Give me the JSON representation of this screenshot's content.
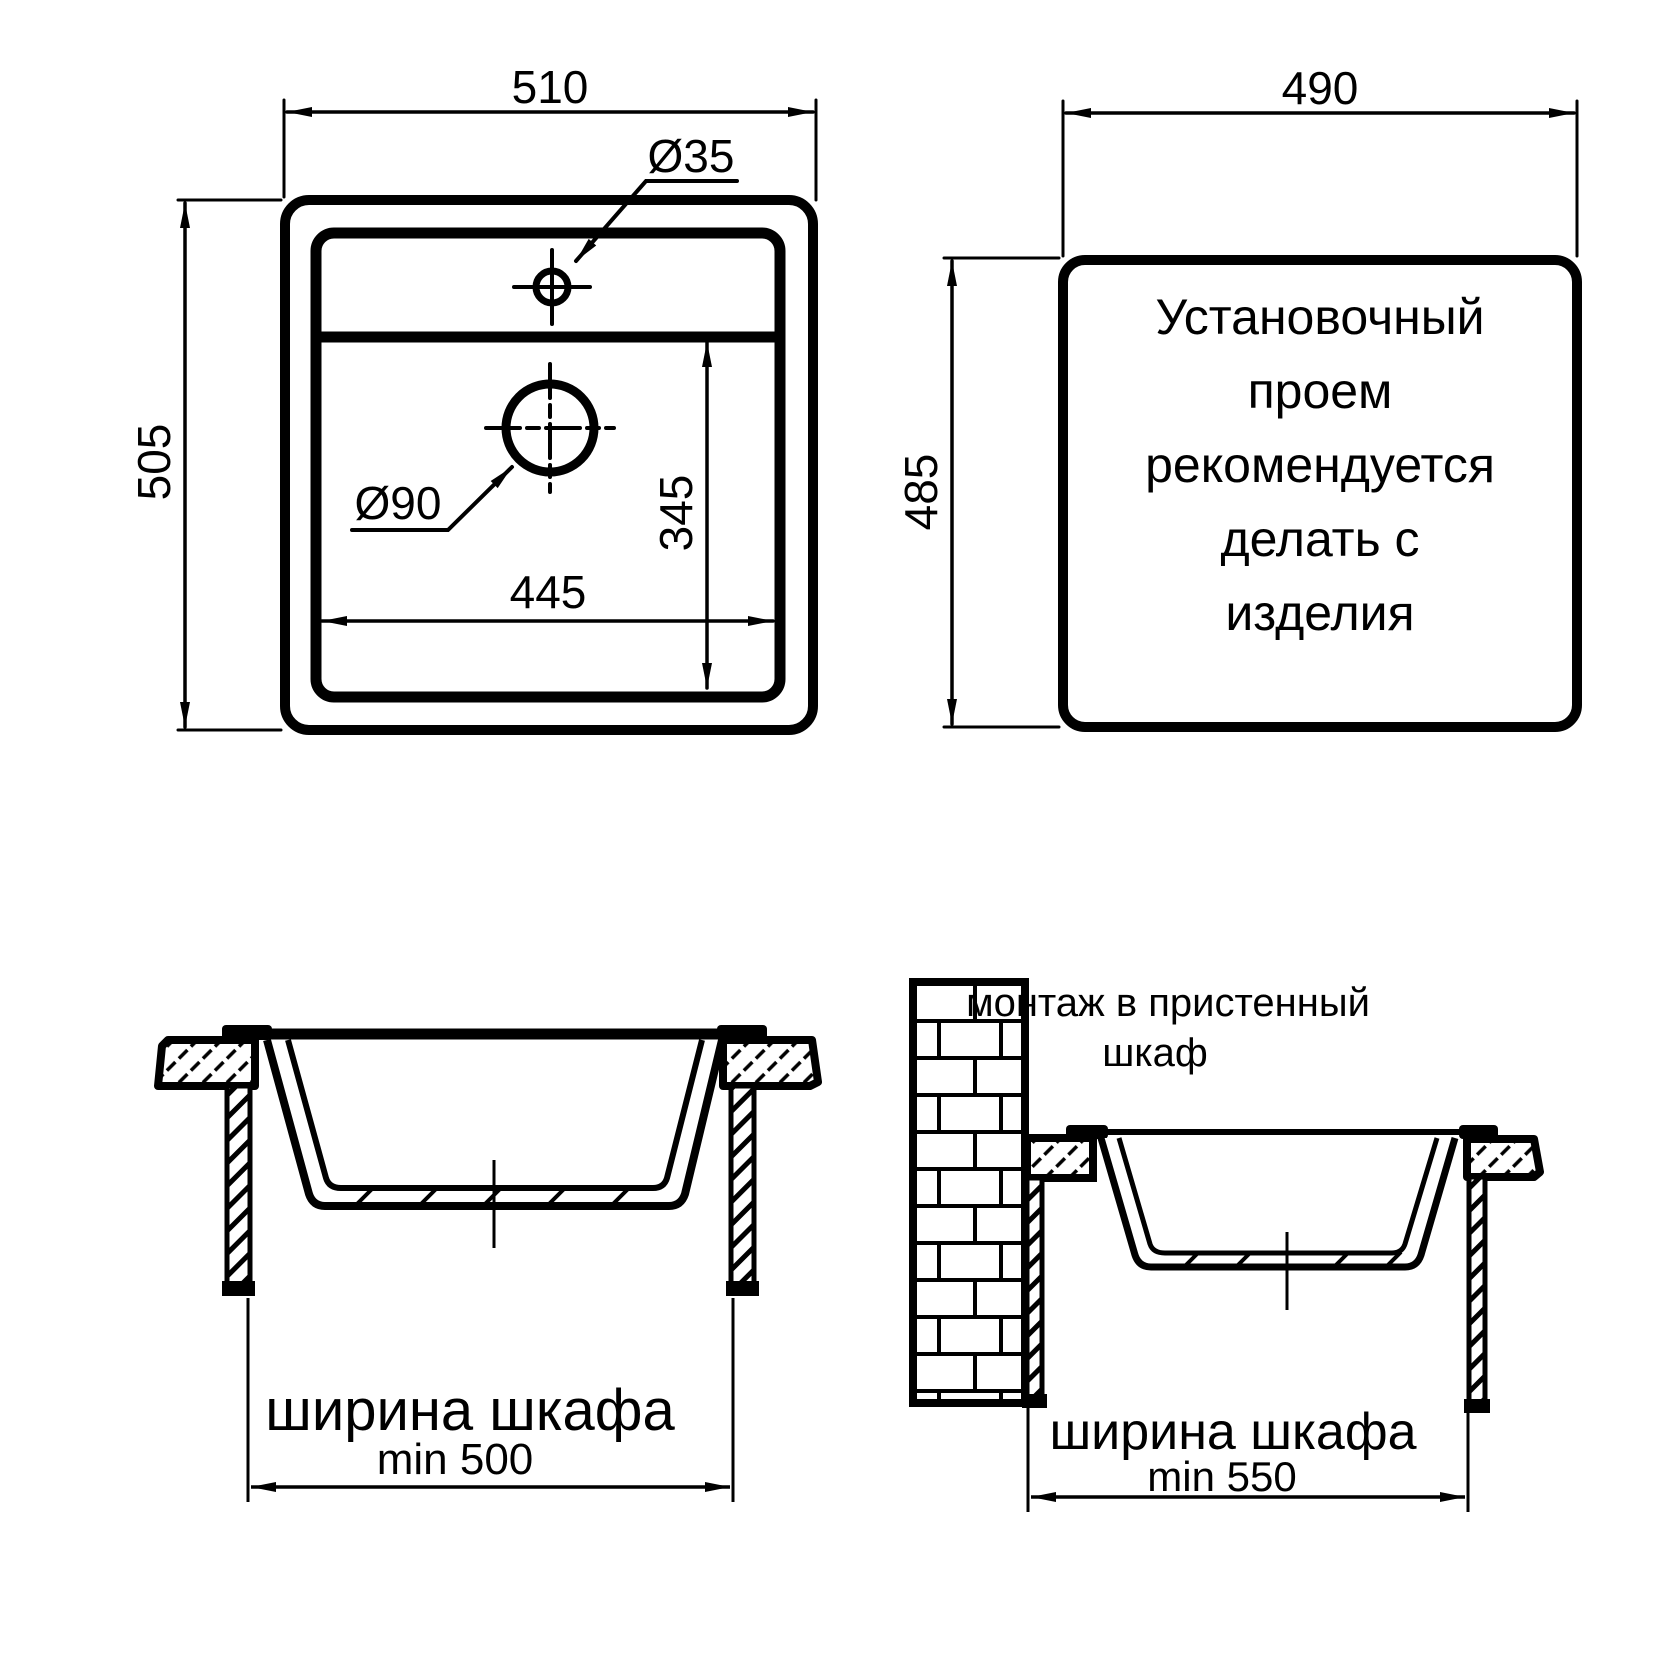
{
  "plan_view": {
    "overall_width": "510",
    "overall_height": "505",
    "faucet_hole": "Ø35",
    "drain_hole": "Ø90",
    "bowl_width": "445",
    "bowl_depth": "345"
  },
  "cutout_view": {
    "width": "490",
    "height": "485",
    "note": [
      "Установочный",
      "проем",
      "рекомендуется",
      "делать с",
      "изделия"
    ]
  },
  "front_section": {
    "label": "ширина шкафа",
    "min_width": "min 500"
  },
  "wall_section": {
    "title_line1": "монтаж в пристенный",
    "title_line2": "шкаф",
    "label": "ширина шкафа",
    "min_width": "min 550"
  },
  "colors": {
    "line": "#000000",
    "background": "#ffffff"
  }
}
